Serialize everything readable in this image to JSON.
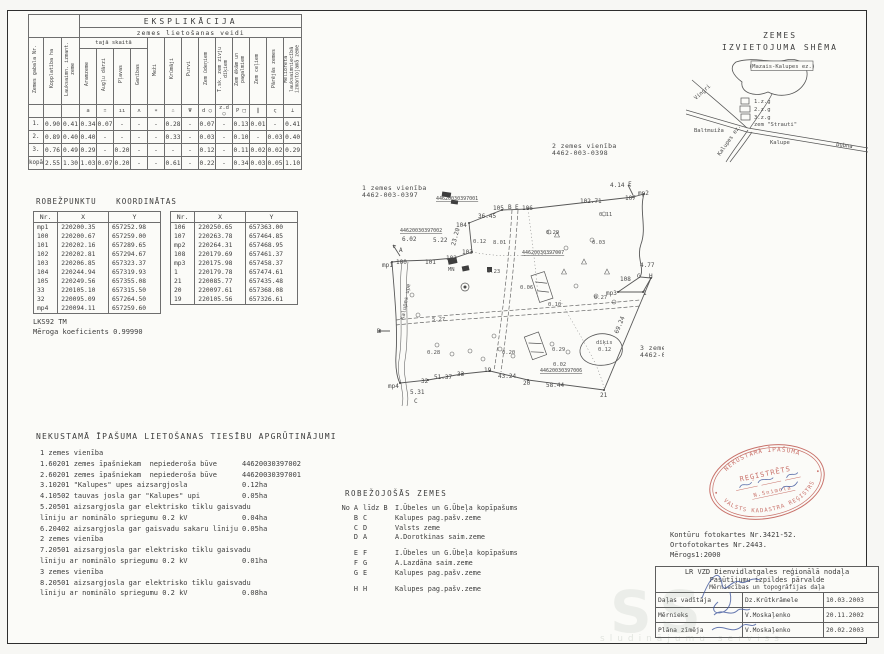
{
  "explication": {
    "title": "EKSPLIKĀCIJA",
    "subtitle": "zemes lietošanas veidi",
    "group_label": "tajā skaitā",
    "columns": [
      "Zemes gabala Nr.",
      "Kopplatība ha",
      "Lauksaimn. izmant. zeme",
      "Aramzeme",
      "Augļu dārzi",
      "Pļavas",
      "Ganības",
      "Meži",
      "Krūmāji",
      "Purvi",
      "Zem ūdeņiem",
      "T.sk. zem zivju dīķiem",
      "Zem ēkām un pagalmiem",
      "Zem ceļiem",
      "Pārējās zemes",
      "Meliorētā lauksaimniecībā izmantojamā zeme"
    ],
    "symbols": [
      "",
      "",
      "a",
      "∷",
      "ıı",
      "ʌ",
      "∗",
      "∴",
      "Ψ",
      "d ○",
      "z.d ○",
      "P □",
      "∥",
      "ς",
      "⊥"
    ],
    "rows": [
      {
        "label": "1.",
        "values": [
          "0.90",
          "0.41",
          "0.34",
          "0.07",
          "-",
          "-",
          "-",
          "0.28",
          "-",
          "0.07",
          "-",
          "0.13",
          "0.01",
          "-",
          "0.41"
        ]
      },
      {
        "label": "2.",
        "values": [
          "0.89",
          "0.40",
          "0.40",
          "-",
          "-",
          "-",
          "-",
          "0.33",
          "-",
          "0.03",
          "-",
          "0.10",
          "-",
          "0.03",
          "0.40"
        ]
      },
      {
        "label": "3.",
        "values": [
          "0.76",
          "0.49",
          "0.29",
          "-",
          "0.20",
          "-",
          "-",
          "-",
          "-",
          "0.12",
          "-",
          "0.11",
          "0.02",
          "0.02",
          "0.29"
        ]
      },
      {
        "label": "kopā",
        "values": [
          "2.55",
          "1.30",
          "1.03",
          "0.07",
          "0.20",
          "-",
          "-",
          "0.61",
          "-",
          "0.22",
          "-",
          "0.34",
          "0.03",
          "0.05",
          "1.10"
        ]
      }
    ]
  },
  "coordinates": {
    "title": "ROBEŽPUNKTU KOORDINĀTAS",
    "headers": [
      "Nr.",
      "X",
      "Y"
    ],
    "table1": [
      [
        "mp1",
        "220200.35",
        "657252.98"
      ],
      [
        "100",
        "220200.67",
        "657259.00"
      ],
      [
        "101",
        "220202.16",
        "657289.65"
      ],
      [
        "102",
        "220202.81",
        "657294.67"
      ],
      [
        "103",
        "220206.85",
        "657323.37"
      ],
      [
        "104",
        "220244.94",
        "657319.93"
      ],
      [
        "105",
        "220249.56",
        "657355.08"
      ],
      [
        "33",
        "220105.10",
        "657315.50"
      ],
      [
        "32",
        "220095.09",
        "657264.50"
      ],
      [
        "mp4",
        "220094.11",
        "657259.60"
      ]
    ],
    "table2": [
      [
        "106",
        "220250.65",
        "657363.00"
      ],
      [
        "107",
        "220263.78",
        "657464.85"
      ],
      [
        "mp2",
        "220264.31",
        "657468.95"
      ],
      [
        "108",
        "220179.69",
        "657461.37"
      ],
      [
        "mp3",
        "220175.98",
        "657458.37"
      ],
      [
        "1",
        "220179.78",
        "657474.61"
      ],
      [
        "21",
        "220085.77",
        "657435.48"
      ],
      [
        "20",
        "220097.61",
        "657368.08"
      ],
      [
        "19",
        "220105.56",
        "657326.61"
      ]
    ],
    "datum": "LKS92 TM",
    "scale_note": "Mēroga koeficients 0.99990"
  },
  "schema": {
    "title_line1": "ZEMES",
    "title_line2": "IZVIETOJUMA SHĒMA",
    "labels": [
      {
        "t": "(Mazais-Kalupes ez.)",
        "x": 96,
        "y": 14,
        "box": 1
      },
      {
        "t": "Vingri",
        "x": 10,
        "y": 46,
        "r": -42
      },
      {
        "t": "Baltmuiža",
        "x": 8,
        "y": 78
      },
      {
        "t": "1.z.g",
        "x": 68,
        "y": 49
      },
      {
        "t": "2.z.g",
        "x": 68,
        "y": 57
      },
      {
        "t": "3.z.g",
        "x": 68,
        "y": 65
      },
      {
        "t": "zem \"Strauti\"",
        "x": 68,
        "y": 72
      },
      {
        "t": "Kalupe",
        "x": 84,
        "y": 90
      },
      {
        "t": "Dubna",
        "x": 150,
        "y": 92,
        "r": 7
      },
      {
        "t": "Kalupes ez.",
        "x": 34,
        "y": 102,
        "r": -55
      }
    ]
  },
  "map": {
    "labels": [
      {
        "t": "1 zemes vienība",
        "x": 10,
        "y": 50,
        "k": "h"
      },
      {
        "t": "4462-003-0397",
        "x": 10,
        "y": 57,
        "k": "h"
      },
      {
        "t": "2 zemes vienība",
        "x": 200,
        "y": 8,
        "k": "h"
      },
      {
        "t": "4462-003-0398",
        "x": 200,
        "y": 15,
        "k": "h"
      },
      {
        "t": "3 zemes vienība",
        "x": 288,
        "y": 210,
        "k": "h"
      },
      {
        "t": "4462-003-0399",
        "x": 288,
        "y": 217,
        "k": "h"
      },
      {
        "t": "44620030397001",
        "x": 84,
        "y": 60,
        "k": "c"
      },
      {
        "t": "44620030397002",
        "x": 48,
        "y": 92,
        "k": "c"
      },
      {
        "t": "44620030397007",
        "x": 170,
        "y": 114,
        "k": "c"
      },
      {
        "t": "44620030397006",
        "x": 188,
        "y": 232,
        "k": "c"
      },
      {
        "t": "mp1",
        "x": 30,
        "y": 127
      },
      {
        "t": "100",
        "x": 44,
        "y": 124
      },
      {
        "t": "101",
        "x": 73,
        "y": 124
      },
      {
        "t": "102",
        "x": 94,
        "y": 120
      },
      {
        "t": "103",
        "x": 110,
        "y": 114
      },
      {
        "t": "104",
        "x": 104,
        "y": 87
      },
      {
        "t": "36.45",
        "x": 126,
        "y": 78
      },
      {
        "t": "105",
        "x": 141,
        "y": 70
      },
      {
        "t": "B",
        "x": 156,
        "y": 69
      },
      {
        "t": "E",
        "x": 163,
        "y": 69
      },
      {
        "t": "106",
        "x": 170,
        "y": 70
      },
      {
        "t": "102.71",
        "x": 228,
        "y": 63
      },
      {
        "t": "107",
        "x": 273,
        "y": 60
      },
      {
        "t": "mp2",
        "x": 286,
        "y": 55
      },
      {
        "t": "4.14",
        "x": 258,
        "y": 47
      },
      {
        "t": "F",
        "x": 276,
        "y": 46
      },
      {
        "t": "4.77",
        "x": 288,
        "y": 127
      },
      {
        "t": "G",
        "x": 285,
        "y": 138
      },
      {
        "t": "H",
        "x": 297,
        "y": 138
      },
      {
        "t": "108",
        "x": 268,
        "y": 141
      },
      {
        "t": "mp3",
        "x": 254,
        "y": 155
      },
      {
        "t": "1",
        "x": 291,
        "y": 155
      },
      {
        "t": "69.24",
        "x": 266,
        "y": 194,
        "r": -68
      },
      {
        "t": "21",
        "x": 248,
        "y": 257
      },
      {
        "t": "58.44",
        "x": 194,
        "y": 247
      },
      {
        "t": "20",
        "x": 171,
        "y": 245
      },
      {
        "t": "43.24",
        "x": 146,
        "y": 238
      },
      {
        "t": "19",
        "x": 132,
        "y": 232
      },
      {
        "t": "33",
        "x": 105,
        "y": 236
      },
      {
        "t": "51.37",
        "x": 82,
        "y": 239
      },
      {
        "t": "32",
        "x": 69,
        "y": 243
      },
      {
        "t": "mp4",
        "x": 36,
        "y": 248
      },
      {
        "t": "5.31",
        "x": 58,
        "y": 254
      },
      {
        "t": "C",
        "x": 62,
        "y": 263
      },
      {
        "t": "D",
        "x": 25,
        "y": 193
      },
      {
        "t": "A",
        "x": 47,
        "y": 112
      },
      {
        "t": "6.02",
        "x": 50,
        "y": 101
      },
      {
        "t": "5.22",
        "x": 81,
        "y": 102
      },
      {
        "t": "23.20",
        "x": 103,
        "y": 106,
        "r": -75
      },
      {
        "t": "MN",
        "x": 96,
        "y": 131,
        "k": "a"
      },
      {
        "t": "Kalupes upe",
        "x": 52,
        "y": 180,
        "r": -80,
        "k": "a"
      },
      {
        "t": "0.12",
        "x": 121,
        "y": 103,
        "k": "a"
      },
      {
        "t": "8.01",
        "x": 141,
        "y": 104,
        "k": "a"
      },
      {
        "t": "0.23",
        "x": 135,
        "y": 133,
        "k": "a"
      },
      {
        "t": "0.06",
        "x": 168,
        "y": 149,
        "k": "a"
      },
      {
        "t": "0.10",
        "x": 196,
        "y": 166,
        "k": "a"
      },
      {
        "t": "0.29",
        "x": 194,
        "y": 94,
        "k": "a"
      },
      {
        "t": "0.11",
        "x": 247,
        "y": 76,
        "k": "a"
      },
      {
        "t": "0.03",
        "x": 240,
        "y": 104,
        "k": "a"
      },
      {
        "t": "0.27",
        "x": 242,
        "y": 159,
        "k": "a"
      },
      {
        "t": "0.28",
        "x": 75,
        "y": 214,
        "k": "a"
      },
      {
        "t": "0.20",
        "x": 150,
        "y": 214,
        "k": "a"
      },
      {
        "t": "0.29",
        "x": 200,
        "y": 211,
        "k": "a"
      },
      {
        "t": "0.02",
        "x": 201,
        "y": 226,
        "k": "a"
      },
      {
        "t": "5.27",
        "x": 80,
        "y": 181,
        "k": "a"
      },
      {
        "t": "dīķis",
        "x": 244,
        "y": 204,
        "k": "a"
      },
      {
        "t": "0.12",
        "x": 246,
        "y": 211,
        "k": "a"
      }
    ]
  },
  "encumbrances": {
    "title": "NEKUSTAMĀ ĪPAŠUMA LIETOŠANAS TIESĪBU APGRŪTINĀJUMI",
    "lines": [
      {
        "t": "1 zemes vienība",
        "v": ""
      },
      {
        "t": "1.60201 zemes īpašniekam  nepiederoša būve",
        "v": "44620030397002"
      },
      {
        "t": "2.60201 zemes īpašniekam  nepiederoša būve",
        "v": "44620030397001"
      },
      {
        "t": "3.10201 \"Kalupes\" upes aizsargjosla",
        "v": "0.12ha"
      },
      {
        "t": "4.10502 tauvas josla gar \"Kalupes\" upi",
        "v": "0.05ha"
      },
      {
        "t": "5.20501 aizsargjosla gar elektrisko tīklu gaisvadu",
        "v": ""
      },
      {
        "t": "līniju ar nominālo spriegumu 0.2 kV",
        "v": "0.04ha"
      },
      {
        "t": "6.20402 aizsargjosla gar gaisvadu sakaru līniju",
        "v": "0.05ha"
      },
      {
        "t": "2 zemes vienība",
        "v": ""
      },
      {
        "t": "7.20501 aizsargjosla gar elektrisko tīklu gaisvadu",
        "v": ""
      },
      {
        "t": "līniju ar nominālo spriegumu 0.2 kV",
        "v": "0.01ha"
      },
      {
        "t": "3 zemes vienība",
        "v": ""
      },
      {
        "t": "8.20501 aizsargjosla gar elektrisko tīklu gaisvadu",
        "v": ""
      },
      {
        "t": "līniju ar nominālo spriegumu 0.2 kV",
        "v": "0.08ha"
      }
    ]
  },
  "bordering": {
    "title": "ROBEŽOJOŠĀS ZEMES",
    "rows": [
      {
        "a": "No A",
        "b": "līdz B",
        "n": "I.Ūbeles un G.Ūbeļa kopīpašums"
      },
      {
        "a": "B",
        "b": "C",
        "n": "Kalupes pag.pašv.zeme"
      },
      {
        "a": "C",
        "b": "D",
        "n": "Valsts zeme"
      },
      {
        "a": "D",
        "b": "A",
        "n": "A.Dorotkinas saim.zeme"
      },
      {
        "a": "E",
        "b": "F",
        "n": "I.Ūbeles un G.Ūbeļa kopīpašums",
        "gap": true
      },
      {
        "a": "F",
        "b": "G",
        "n": "A.Lazdāna saim.zeme"
      },
      {
        "a": "G",
        "b": "E",
        "n": "Kalupes pag.pašv.zeme"
      },
      {
        "a": "H",
        "b": "H",
        "n": "Kalupes pag.pašv.zeme",
        "gap": true
      }
    ]
  },
  "footer": {
    "line1": "Kontūru fotokartes Nr.3421-52.",
    "line2": "Ortofotokartes Nr.2443.",
    "line3": "Mērogs1:2000"
  },
  "signtable": {
    "org1": "LR VZD Dienvidlatgales reģionālā nodaļa",
    "org2": "Pasūtījumu izpildes pārvalde",
    "org3": "Mērniecības un topogrāfijas daļa",
    "rows": [
      {
        "role": "Daļas vadītāja",
        "name": "Dz.Krūtkrāmele",
        "date": "10.03.2003"
      },
      {
        "role": "Mērnieks",
        "name": "V.Moskaļenko",
        "date": "20.11.2002"
      },
      {
        "role": "Plāna zīmēja",
        "name": "V.Moskaļenko",
        "date": "20.02.2003"
      }
    ]
  },
  "stamp": {
    "arc_top": "NEKUSTAMĀ ĪPAŠUMA",
    "arc_bottom": "VALSTS KADASTRA REĢISTRS",
    "center1": "REĢISTRĒTS",
    "center2": "N.Snimola"
  },
  "watermark": {
    "big": "SS",
    "small": "sludinājumu serviss"
  },
  "colors": {
    "ink": "#3c3c3c",
    "map_ink": "#555555",
    "stamp_red": "#c05a52",
    "signature_blue": "#41589e"
  }
}
